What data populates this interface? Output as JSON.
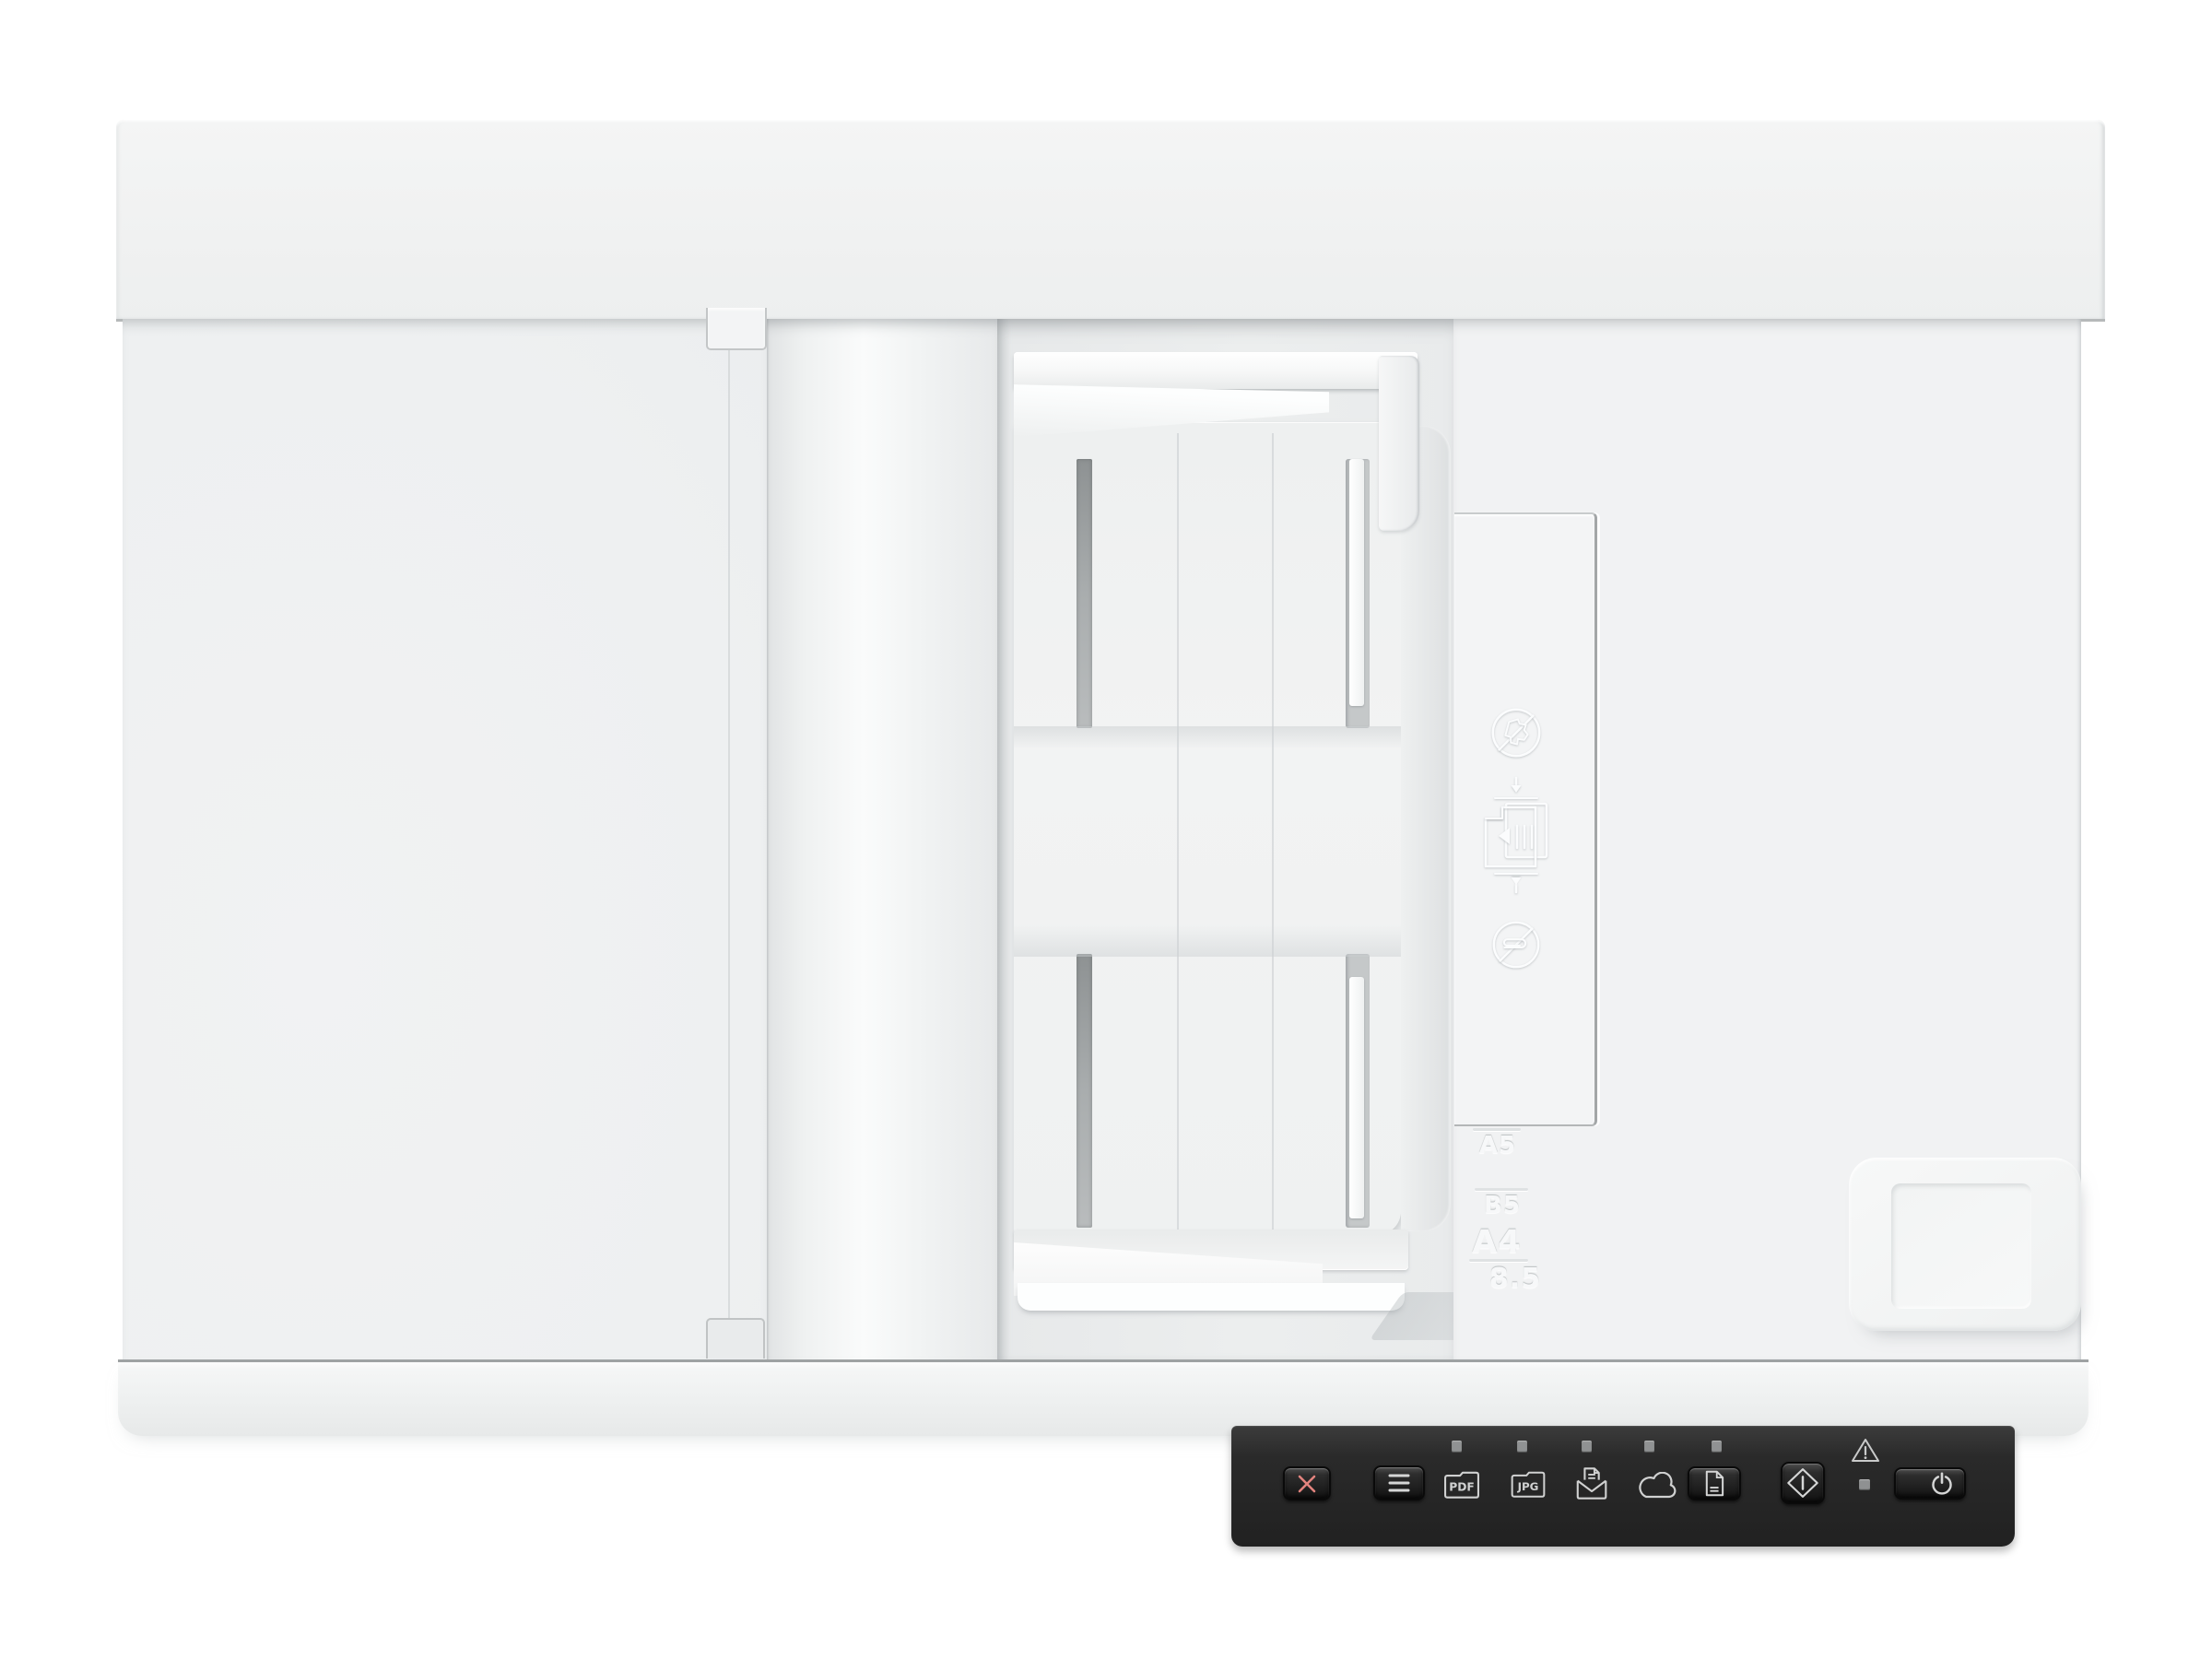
{
  "device": {
    "kind": "Flatbed document scanner with automatic document feeder, top view"
  },
  "adf_markings": {
    "paper_sizes": [
      {
        "label": "A5"
      },
      {
        "label": "B5"
      },
      {
        "label": "A4"
      },
      {
        "label": "8.5"
      }
    ],
    "instruction_icons": [
      "no-damaged-paper-icon",
      "load-paper-arrows-icon",
      "no-paperclips-icon"
    ]
  },
  "control_panel": {
    "pdf_label": "PDF",
    "jpg_label": "JPG",
    "icons": [
      "cancel-x-icon",
      "menu-icon",
      "pdf-folder-icon",
      "jpg-folder-icon",
      "scan-to-email-icon",
      "scan-to-cloud-icon",
      "document-icon",
      "start-scan-icon",
      "warning-icon",
      "power-icon"
    ],
    "destination_led_count": 5,
    "colors": {
      "panel_bg": "#282828",
      "icon_stroke": "#d5d6d6",
      "cancel_x": "#e2837e",
      "led": "#909293"
    }
  },
  "palette": {
    "background": "#ffffff",
    "device_body": "#f0f1f2",
    "seam_dark": "#a9acad",
    "slot_gray": "#9ea2a3"
  }
}
